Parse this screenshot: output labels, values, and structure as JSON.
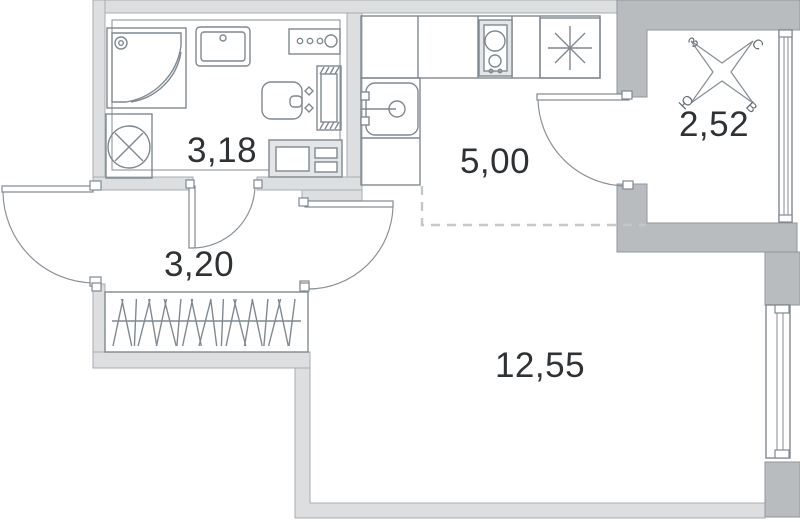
{
  "rooms": {
    "bathroom": {
      "area": "3,18"
    },
    "hallway": {
      "area": "3,20"
    },
    "kitchen": {
      "area": "5,00"
    },
    "living_room": {
      "area": "12,55"
    },
    "balcony": {
      "area": "2,52"
    }
  },
  "compass": {
    "north": "С",
    "south": "Ю",
    "west": "З",
    "east": "В"
  },
  "colors": {
    "wall_light": "#dcdedf",
    "wall_dark": "#b9bcbf",
    "line": "#7f898f",
    "dashed_zone_line": "#c3c7ca",
    "text": "#2e3235"
  },
  "icons": [
    "shower-icon",
    "washing-machine-icon",
    "bathroom-sink-icon",
    "appliance-panel-icon",
    "toilet-icon",
    "toilet-frame-icon",
    "bathroom-cabinet-icon",
    "kitchen-sink-icon",
    "stove-icon",
    "refrigerator-icon",
    "wardrobe-hangers-icon",
    "window-icon",
    "balcony-window-icon",
    "compass-rose-icon",
    "door-swing-icon"
  ]
}
